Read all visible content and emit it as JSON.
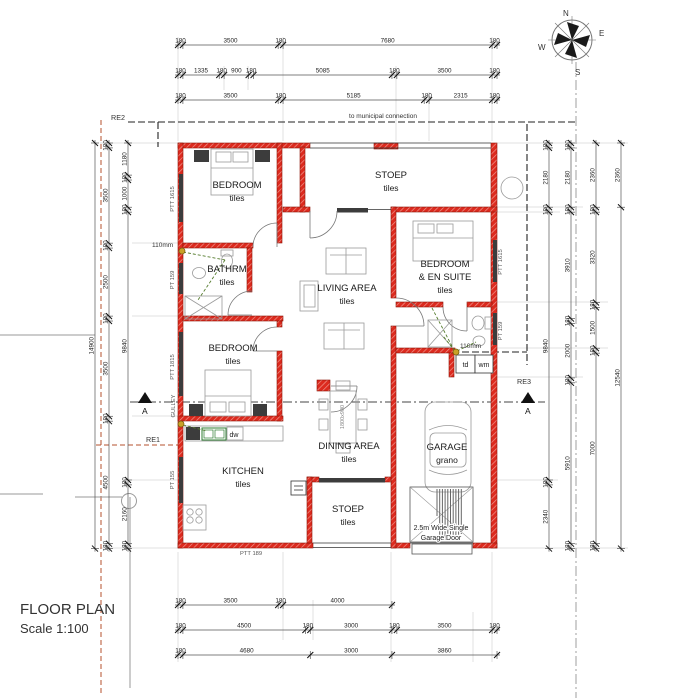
{
  "title": {
    "name": "FLOOR PLAN",
    "scale": "Scale 1:100"
  },
  "compass": {
    "n": "N",
    "e": "E",
    "s": "S",
    "w": "W"
  },
  "notes": {
    "municipal": "to municipal connection",
    "re1": "RE1",
    "re2": "RE2",
    "re3": "RE3",
    "gulley": "GULLEY",
    "pipe_bath": "110mm",
    "pipe_ensuite": "110mm",
    "section_a": "A",
    "garage_door_l1": "2.5m Wide Single",
    "garage_door_l2": "Garage Door",
    "table_size": "1800x900",
    "wall_label": "PTT 189"
  },
  "rooms": [
    {
      "id": "bedroom1",
      "lines": [
        "BEDROOM",
        "tiles"
      ]
    },
    {
      "id": "stoep-top",
      "lines": [
        "STOEP",
        "tiles"
      ]
    },
    {
      "id": "bedroom-ensuite",
      "lines": [
        "BEDROOM",
        "& EN SUITE",
        "tiles"
      ]
    },
    {
      "id": "living",
      "lines": [
        "LIVING AREA",
        "tiles"
      ]
    },
    {
      "id": "bathroom",
      "lines": [
        "BATHRM",
        "tiles"
      ]
    },
    {
      "id": "bedroom2",
      "lines": [
        "BEDROOM",
        "tiles"
      ]
    },
    {
      "id": "kitchen",
      "lines": [
        "KITCHEN",
        "tiles"
      ]
    },
    {
      "id": "dining",
      "lines": [
        "DINING AREA",
        "tiles"
      ]
    },
    {
      "id": "stoep-bottom",
      "lines": [
        "STOEP",
        "tiles"
      ]
    },
    {
      "id": "garage",
      "lines": [
        "GARAGE",
        "grano"
      ]
    }
  ],
  "windows": [
    {
      "id": "bedroom1-left",
      "label": "PTT 1615"
    },
    {
      "id": "bathroom-left",
      "label": "PT 159"
    },
    {
      "id": "bedroom2-left",
      "label": "PTT 1815"
    },
    {
      "id": "kitchen-left",
      "label": "PT 155"
    },
    {
      "id": "ensuite-bedroom-right",
      "label": "PTT 1615"
    },
    {
      "id": "ensuite-bath-right",
      "label": "PT 159"
    }
  ],
  "appliances": {
    "dw": "dw",
    "td": "td",
    "wm": "wm"
  },
  "dimensions": {
    "unit": "mm",
    "top_rows": [
      [
        180,
        3500,
        180,
        7680,
        180
      ],
      [
        180,
        1335,
        180,
        900,
        180,
        5085,
        180,
        3500,
        180
      ],
      [
        180,
        3500,
        180,
        5185,
        180,
        2315,
        180
      ]
    ],
    "bottom_rows": [
      [
        180,
        3500,
        180,
        4000
      ],
      [
        180,
        4500,
        180,
        3000,
        180,
        3500,
        180
      ],
      [
        180,
        4680,
        3000,
        3860
      ]
    ],
    "left_cols": [
      [
        14900
      ],
      [
        180,
        3500,
        180,
        2500,
        180,
        3500,
        180,
        4500,
        180
      ],
      [
        1180,
        180,
        1000,
        180,
        9840,
        180,
        2160,
        180
      ]
    ],
    "right_cols": [
      [
        180,
        2180,
        180,
        9840,
        180,
        2340
      ],
      [
        180,
        2180,
        180,
        3910,
        180,
        2000,
        180,
        5910,
        180
      ],
      [
        2360,
        180,
        3320,
        180,
        1500,
        180,
        7000,
        180
      ],
      [
        2360,
        12540
      ]
    ]
  },
  "colors": {
    "wall_red": "#dc2a1e",
    "window_dark": "#3c3c3c",
    "boundary_red": "#b4502e",
    "sewer_green": "#567d2e",
    "dim_text": "#222222"
  }
}
